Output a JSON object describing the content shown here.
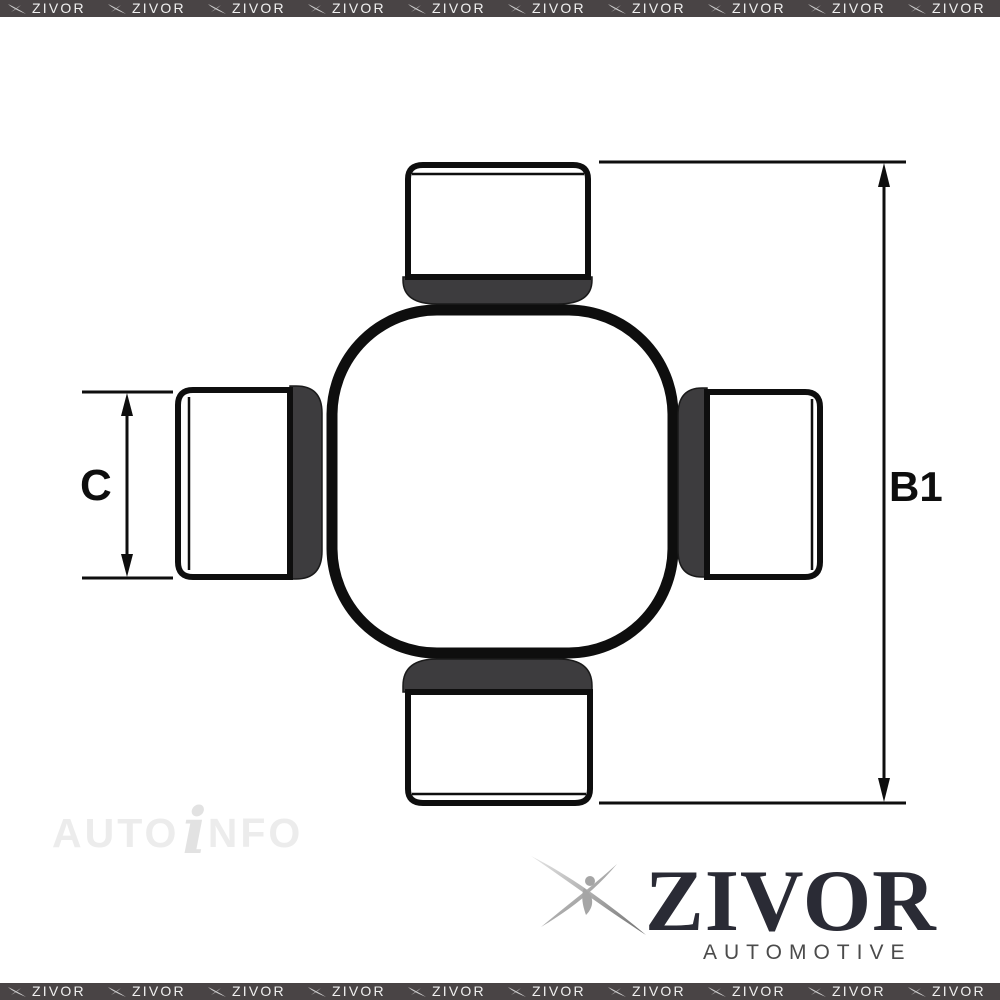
{
  "page": {
    "background": "#ffffff",
    "kind": "product-image"
  },
  "watermark_border": {
    "brand": "ZIVOR",
    "background": "#494445",
    "text_color": "#f0f0f0",
    "repeats_per_strip": 10
  },
  "diagram": {
    "subject": "universal-joint-cross",
    "dim_c_label": "C",
    "dim_b1_label": "B1",
    "outline_color": "#0e0e0e",
    "collar_color": "#3d3c3e",
    "cap_fill": "#ffffff"
  },
  "autoinfo_watermark": {
    "part1": "AUTO",
    "part2": "i",
    "part3": "NFO"
  },
  "brand_logo": {
    "name": "ZIVOR",
    "tagline": "AUTOMOTIVE",
    "name_color": "#2a2b35",
    "tagline_color": "#4b4b4b"
  }
}
